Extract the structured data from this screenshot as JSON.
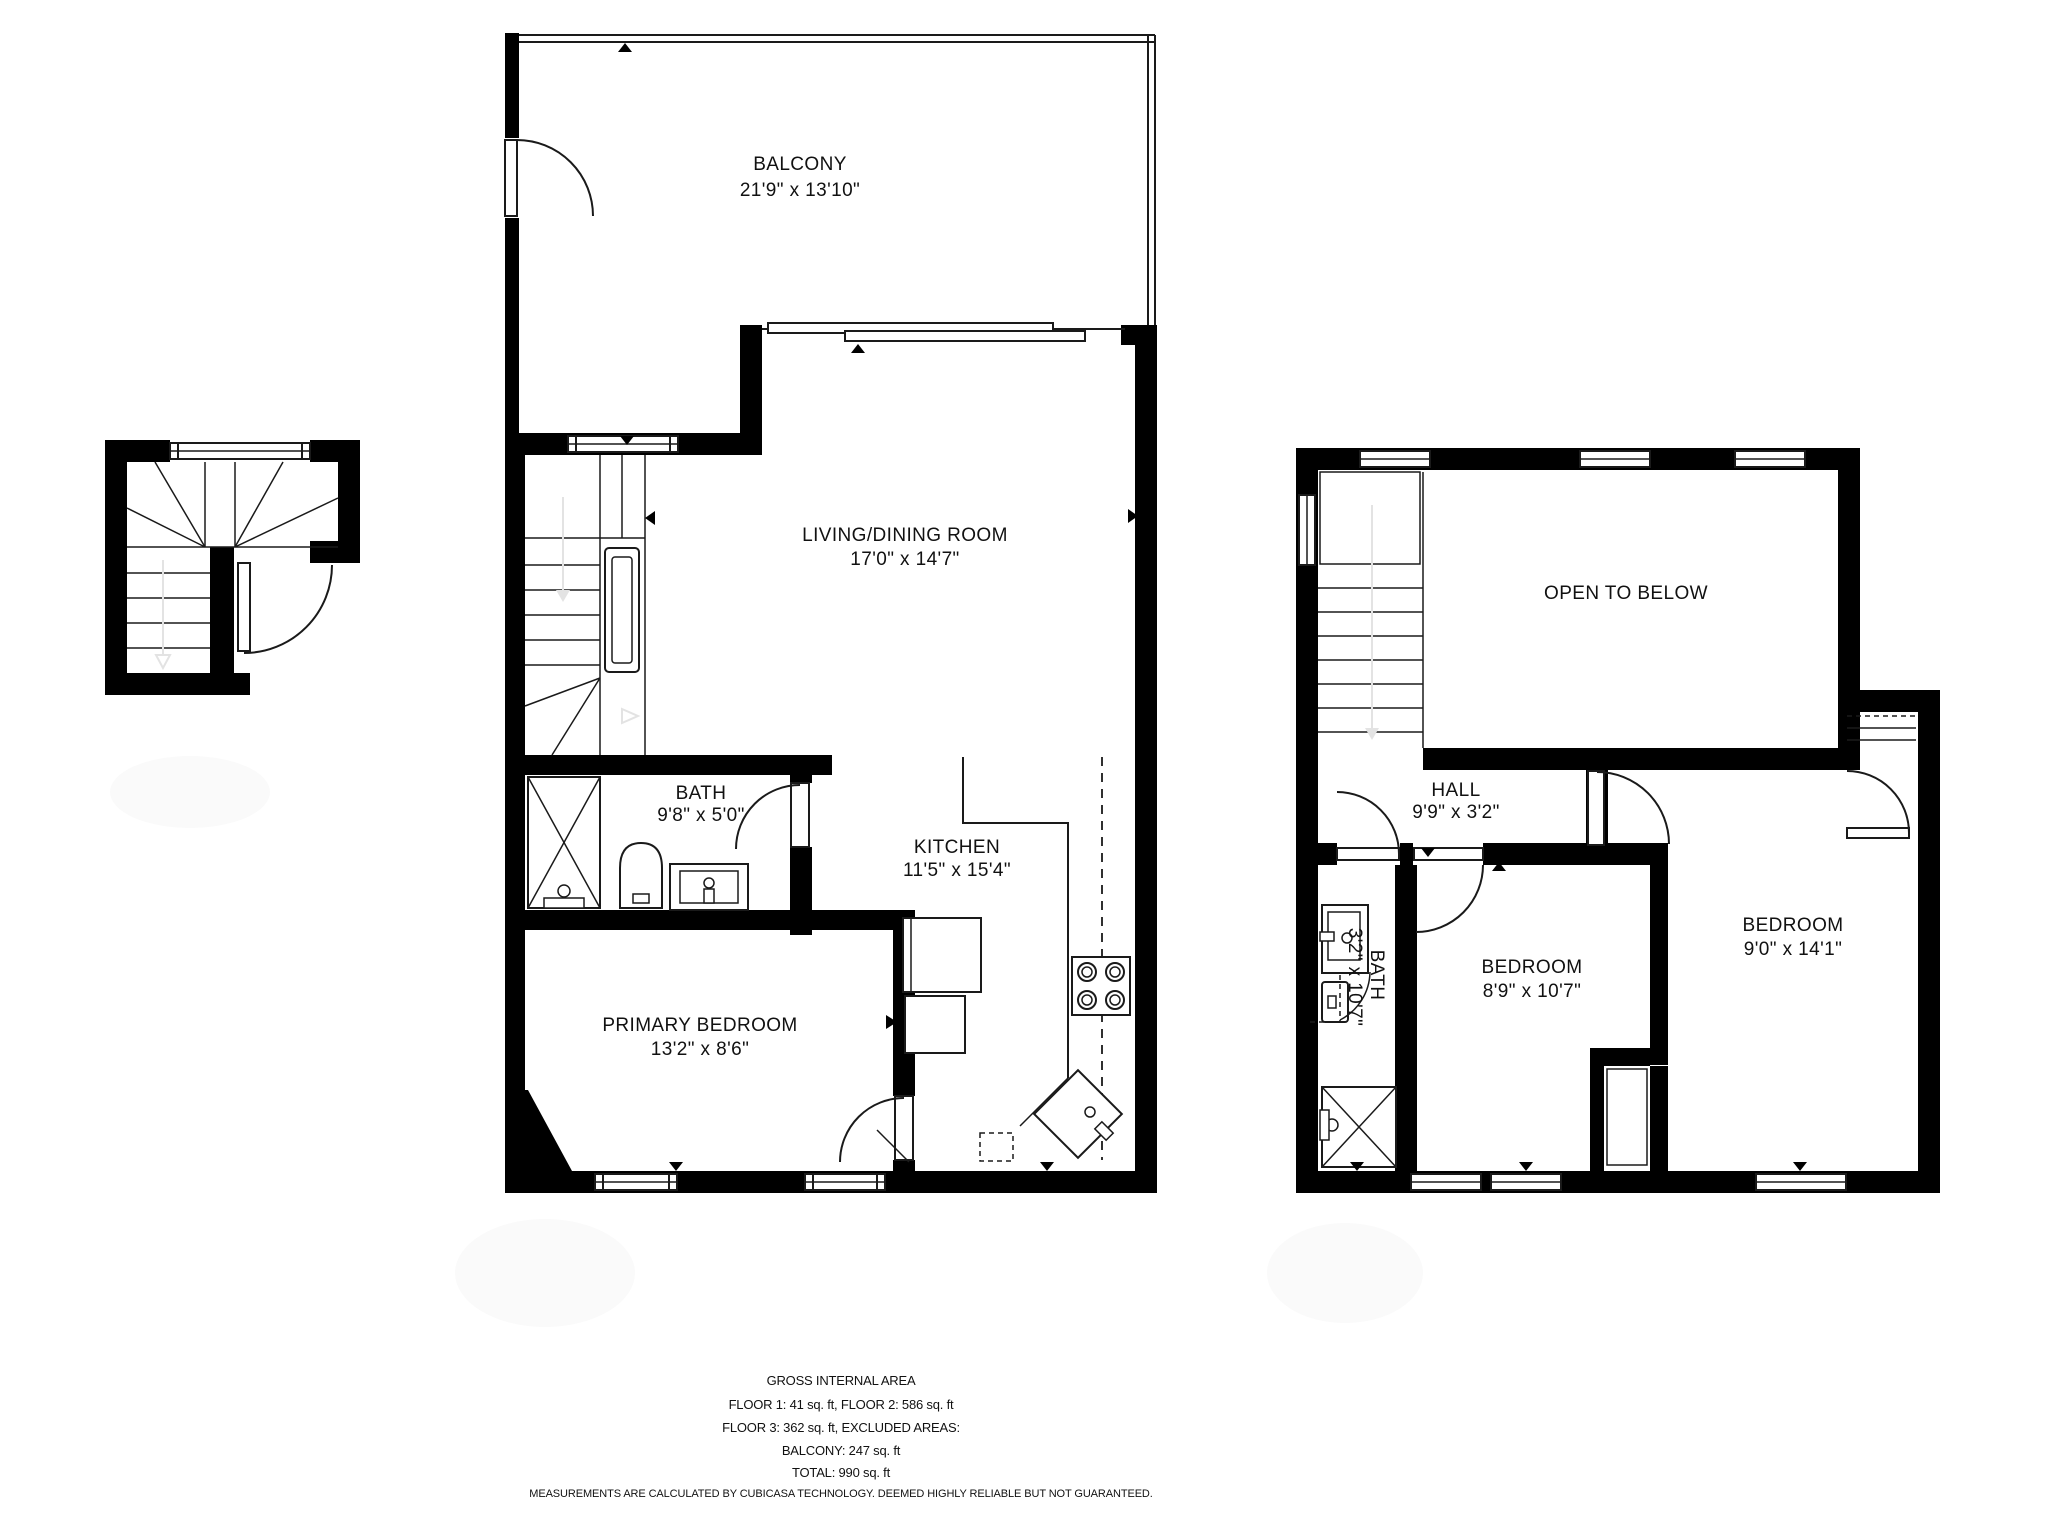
{
  "floor_plan": {
    "floor2": {
      "balcony": {
        "label": "BALCONY",
        "dims": "21'9\" x 13'10\""
      },
      "living_dining": {
        "label": "LIVING/DINING ROOM",
        "dims": "17'0\" x 14'7\""
      },
      "bath": {
        "label": "BATH",
        "dims": "9'8\" x 5'0\""
      },
      "kitchen": {
        "label": "KITCHEN",
        "dims": "11'5\" x 15'4\""
      },
      "primary_bedroom": {
        "label": "PRIMARY BEDROOM",
        "dims": "13'2\" x 8'6\""
      }
    },
    "floor3": {
      "open_to_below": {
        "label": "OPEN TO BELOW"
      },
      "hall": {
        "label": "HALL",
        "dims": "9'9\" x 3'2\""
      },
      "bath": {
        "label": "BATH",
        "dims": "3'2\" x 10'7\""
      },
      "bedroom_left": {
        "label": "BEDROOM",
        "dims": "8'9\" x 10'7\""
      },
      "bedroom_right": {
        "label": "BEDROOM",
        "dims": "9'0\" x 14'1\""
      }
    },
    "footer": {
      "line1": "GROSS INTERNAL AREA",
      "line2": "FLOOR 1: 41 sq. ft, FLOOR 2: 586 sq. ft",
      "line3": "FLOOR 3: 362 sq. ft, EXCLUDED AREAS:",
      "line4": "BALCONY: 247 sq. ft",
      "line5": "TOTAL: 990 sq. ft",
      "disclaimer": "MEASUREMENTS ARE CALCULATED BY CUBICASA TECHNOLOGY. DEEMED HIGHLY RELIABLE BUT NOT GUARANTEED."
    },
    "colors": {
      "wall": "#000000",
      "line": "#1a1a1a",
      "faint": "#e3e3e3"
    }
  }
}
